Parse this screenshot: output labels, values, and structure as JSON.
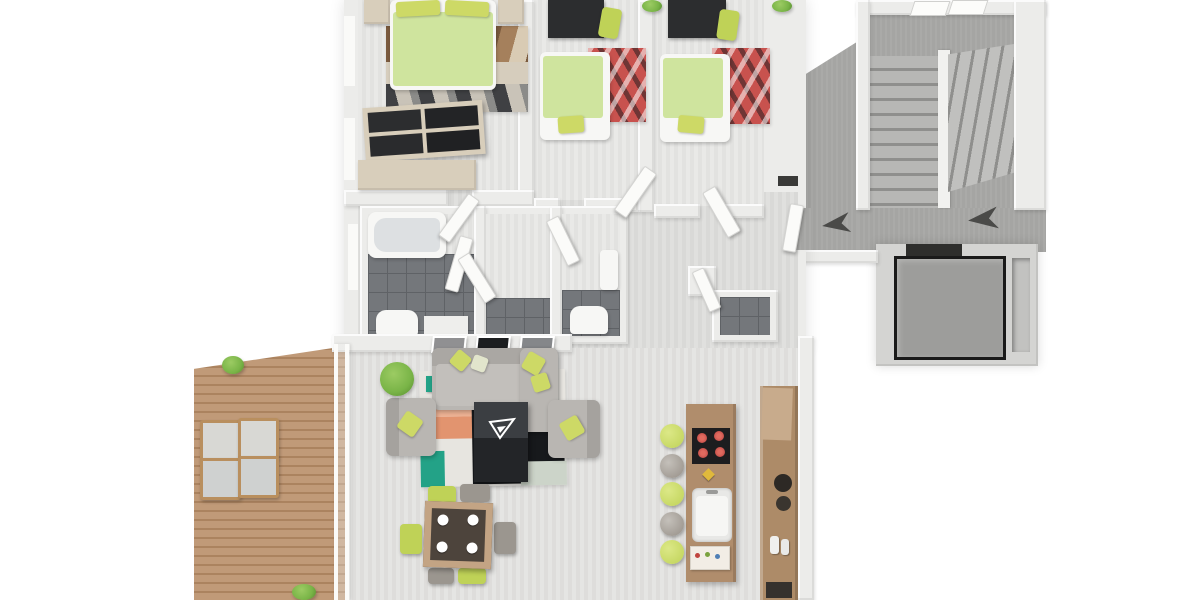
{
  "scene": {
    "type": "3d-floor-plan",
    "description": "3D top-down floor plan rendering of an apartment with terrace, three bedrooms, bathroom, open living-dining-kitchen and a stairwell with elevator"
  },
  "colors": {
    "background": "#ffffff",
    "wall": "#ececea",
    "wall_bright": "#fafaf8",
    "floor_light": "#e9e9e7",
    "floor_living": "#e5e5e3",
    "floor_hall": "#e0e0de",
    "landing_carpet": "#a5a5a3",
    "stair_step": "#b7b7b5",
    "stair_riser": "#8f8f8d",
    "tile_dark": "#74777b",
    "tile_line": "#5f6266",
    "bed_green": "#cfe49e",
    "pillow_lime": "#cdd966",
    "accent_lime": "#bfd257",
    "sofa_gray": "#b9b6b2",
    "rug_teal": "#23a287",
    "rug_orange": "#e2946f",
    "rug_black": "#17191c",
    "rug_red": "#c8524e",
    "desk_dark": "#2c2d2f",
    "wood_frame": "#d8cebb",
    "kitchen_wood": "#b08d6c",
    "cooktop_black": "#1d1d1f",
    "burner_red": "#b8403e",
    "deck_wood": "#c09a78",
    "deck_line": "#ab835f",
    "plant_green": "#79b447",
    "elevator_gray": "#9d9d9b",
    "elevator_border": "#1a1a1a",
    "arrow_dark": "#4a4a48",
    "table_black": "#232528",
    "dining_wood": "#c3a484",
    "dining_top": "#4d443c"
  },
  "rooms": {
    "master_bedroom": {
      "label": "master bedroom",
      "furniture": [
        "double bed with green duvet",
        "two lime pillows",
        "nightstands",
        "patterned rug",
        "dark wardrobe",
        "sideboard"
      ]
    },
    "kids_bedroom_1": {
      "label": "bedroom 2",
      "furniture": [
        "single bed with green duvet",
        "desk",
        "lime desk chair",
        "red rug",
        "plant"
      ]
    },
    "kids_bedroom_2": {
      "label": "bedroom 3",
      "furniture": [
        "single bed with green duvet",
        "desk",
        "lime desk chair",
        "red rug",
        "plant"
      ]
    },
    "bathroom": {
      "label": "bathroom",
      "furniture": [
        "bathtub",
        "toilet",
        "glass shower doors",
        "dark tile floor"
      ]
    },
    "wc": {
      "label": "wc",
      "furniture": [
        "toilet",
        "washbasin"
      ]
    },
    "hallway": {
      "label": "hallway",
      "furniture": [
        "open doors",
        "storage closet"
      ]
    },
    "living_area": {
      "label": "open living, dining and kitchen",
      "furniture": [
        "gray sofa with chaise",
        "two armchairs",
        "lime pillows",
        "black coffee table with logo",
        "patchwork rug",
        "potted plant",
        "dining table with four plates",
        "six chairs",
        "kitchen island with cooktop and sink",
        "five bar stools",
        "tall kitchen cabinet",
        "three wall pictures"
      ]
    },
    "terrace": {
      "label": "terrace",
      "furniture": [
        "wood deck",
        "four outdoor chairs",
        "two plants"
      ]
    },
    "stairwell": {
      "label": "stairwell and landing",
      "furniture": [
        "u-shaped staircase",
        "two windows",
        "direction arrows",
        "elevator cabin",
        "service shaft"
      ]
    }
  }
}
